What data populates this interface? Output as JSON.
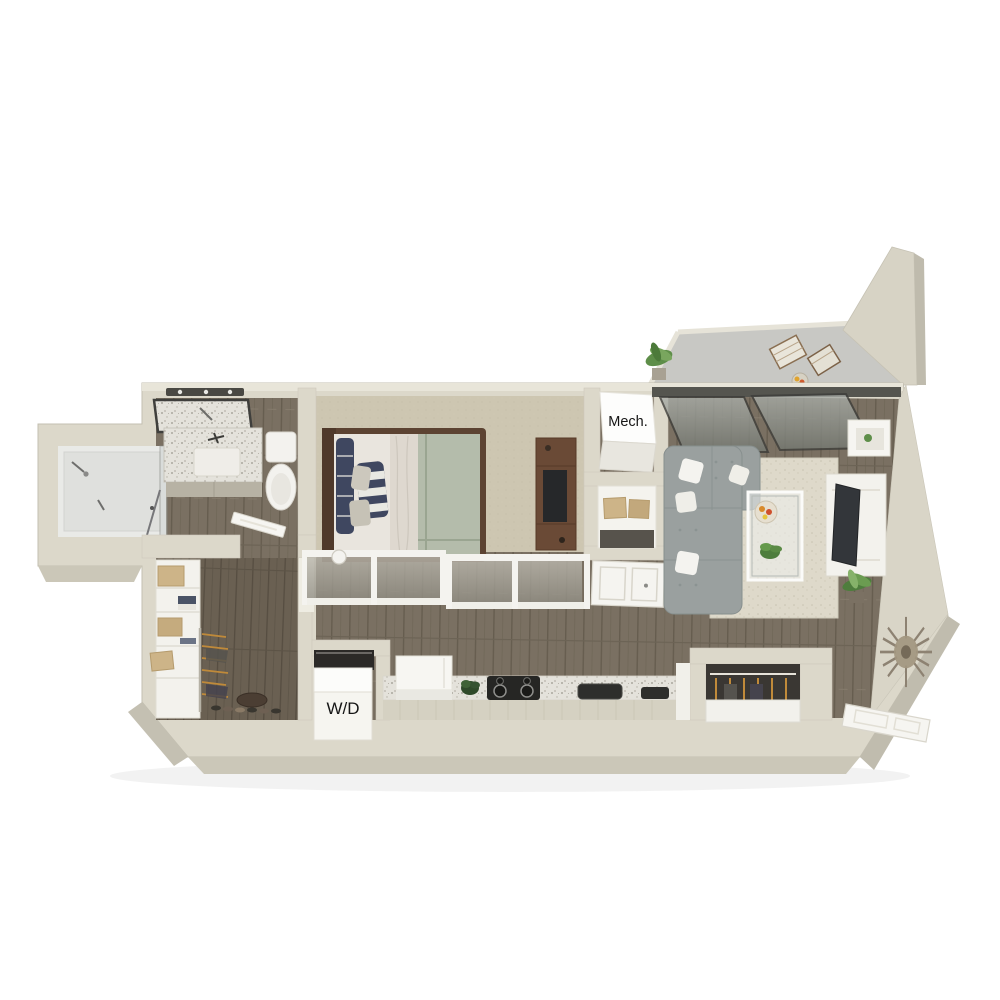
{
  "scene": {
    "type": "3D apartment floor plan render",
    "background": "#ffffff",
    "rooms": [
      "balcony",
      "living room",
      "bedroom",
      "bathroom",
      "shower",
      "walk-in closet",
      "hallway",
      "kitchen",
      "entry",
      "mechanical closet",
      "laundry closet"
    ]
  },
  "labels": {
    "mech": "Mech.",
    "wd": "W/D"
  },
  "palette": {
    "wall": "#dcd8ca",
    "wall_top": "#e8e5d9",
    "wall_shadow": "#c0bcae",
    "wood_floor": "#7a7062",
    "wood_floor_dark": "#6a6052",
    "carpet": "#cdc6b1",
    "concrete": "#c8c8c4",
    "counter_terrazzo": "#e4e2db",
    "cabinet_front": "#d5d1c2",
    "sofa": "#9aa09f",
    "rug": "#ded9ca",
    "bed_duvet": "#b4bcab",
    "bed_sheet": "#e9e5de",
    "pillow_navy": "#3f4760",
    "wood_furniture": "#6a4a36",
    "appliance_dark": "#2a2a28",
    "box_tan": "#cdb488",
    "plant_green": "#5e8e49",
    "label_text": "#161616"
  }
}
